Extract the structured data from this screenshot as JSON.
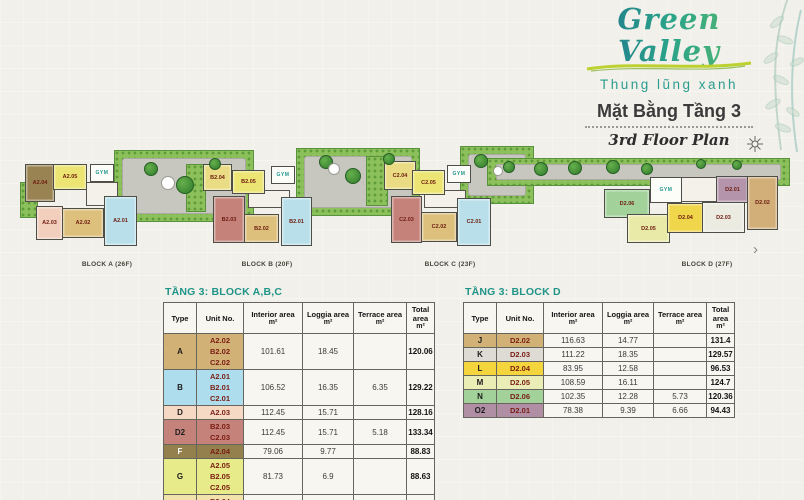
{
  "brand": {
    "name": "Green Valley",
    "tagline": "Thung lũng xanh",
    "plan_title_vi": "Mặt Bằng Tầng 3",
    "plan_title_en": "3rd Floor Plan",
    "teal": "#2a9d8f",
    "accent_green": "#bcd12f"
  },
  "plan": {
    "gym_label": "GYM",
    "next_arrow": "›",
    "blocks": [
      {
        "name": "BLOCK A (26F)",
        "label_x": 107,
        "gym": {
          "x": 90,
          "y": 164,
          "w": 22,
          "h": 16
        },
        "cores": [
          {
            "x": 86,
            "y": 182,
            "w": 30,
            "h": 22
          }
        ],
        "units": [
          {
            "id": "A2.04",
            "x": 25,
            "y": 164,
            "w": 28,
            "h": 36,
            "c": "#998352"
          },
          {
            "id": "A2.05",
            "x": 53,
            "y": 164,
            "w": 32,
            "h": 24,
            "c": "#ece573"
          },
          {
            "id": "A2.03",
            "x": 36,
            "y": 206,
            "w": 25,
            "h": 32,
            "c": "#f2cfbc"
          },
          {
            "id": "A2.02",
            "x": 62,
            "y": 208,
            "w": 40,
            "h": 28,
            "c": "#ddc07c"
          },
          {
            "id": "A2.01",
            "x": 104,
            "y": 196,
            "w": 31,
            "h": 48,
            "c": "#b9e0ea"
          }
        ]
      },
      {
        "name": "BLOCK B (20F)",
        "label_x": 267,
        "gym": {
          "x": 271,
          "y": 166,
          "w": 22,
          "h": 16
        },
        "cores": [
          {
            "x": 248,
            "y": 190,
            "w": 40,
            "h": 16
          }
        ],
        "units": [
          {
            "id": "B2.04",
            "x": 203,
            "y": 164,
            "w": 27,
            "h": 25,
            "c": "#eadc84"
          },
          {
            "id": "B2.05",
            "x": 232,
            "y": 170,
            "w": 31,
            "h": 22,
            "c": "#ece573"
          },
          {
            "id": "B2.03",
            "x": 213,
            "y": 196,
            "w": 30,
            "h": 45,
            "c": "#c5827a"
          },
          {
            "id": "B2.02",
            "x": 244,
            "y": 214,
            "w": 33,
            "h": 27,
            "c": "#ddc07c"
          },
          {
            "id": "B2.01",
            "x": 281,
            "y": 197,
            "w": 29,
            "h": 47,
            "c": "#b9e0ea"
          }
        ]
      },
      {
        "name": "BLOCK C (23F)",
        "label_x": 450,
        "gym": {
          "x": 447,
          "y": 165,
          "w": 22,
          "h": 16
        },
        "cores": [
          {
            "x": 424,
            "y": 190,
            "w": 40,
            "h": 16
          }
        ],
        "units": [
          {
            "id": "C2.04",
            "x": 384,
            "y": 161,
            "w": 30,
            "h": 27,
            "c": "#eadc84"
          },
          {
            "id": "C2.05",
            "x": 412,
            "y": 170,
            "w": 31,
            "h": 23,
            "c": "#ece573"
          },
          {
            "id": "C2.03",
            "x": 391,
            "y": 196,
            "w": 29,
            "h": 45,
            "c": "#c5827a"
          },
          {
            "id": "C2.02",
            "x": 421,
            "y": 212,
            "w": 34,
            "h": 28,
            "c": "#ddc07c"
          },
          {
            "id": "C2.01",
            "x": 457,
            "y": 198,
            "w": 32,
            "h": 46,
            "c": "#b9e0ea"
          }
        ]
      },
      {
        "name": "BLOCK D (27F)",
        "label_x": 707,
        "gym": {
          "x": 650,
          "y": 177,
          "w": 30,
          "h": 24
        },
        "cores": [
          {
            "x": 681,
            "y": 177,
            "w": 34,
            "h": 23
          }
        ],
        "units": [
          {
            "id": "D2.06",
            "x": 604,
            "y": 189,
            "w": 44,
            "h": 27,
            "c": "#a2d29a"
          },
          {
            "id": "D2.05",
            "x": 627,
            "y": 214,
            "w": 41,
            "h": 27,
            "c": "#e9e9a8"
          },
          {
            "id": "D2.04",
            "x": 667,
            "y": 203,
            "w": 35,
            "h": 28,
            "c": "#f0d64a"
          },
          {
            "id": "D2.03",
            "x": 702,
            "y": 202,
            "w": 41,
            "h": 29,
            "c": "#ecebe2"
          },
          {
            "id": "D2.01",
            "x": 716,
            "y": 176,
            "w": 31,
            "h": 25,
            "c": "#b394ab"
          },
          {
            "id": "D2.02",
            "x": 747,
            "y": 176,
            "w": 29,
            "h": 52,
            "c": "#d2ae79"
          }
        ]
      }
    ],
    "gardens": [
      {
        "x": 114,
        "y": 150,
        "w": 138,
        "h": 70,
        "deck": "full"
      },
      {
        "x": 296,
        "y": 148,
        "w": 122,
        "h": 66,
        "deck": "full"
      },
      {
        "x": 460,
        "y": 146,
        "w": 72,
        "h": 56,
        "deck": "full"
      },
      {
        "x": 487,
        "y": 158,
        "w": 301,
        "h": 26,
        "deck": "strip"
      },
      {
        "x": 20,
        "y": 182,
        "w": 16,
        "h": 34
      },
      {
        "x": 186,
        "y": 164,
        "w": 18,
        "h": 46
      },
      {
        "x": 366,
        "y": 156,
        "w": 20,
        "h": 48
      }
    ],
    "trees": [
      {
        "x": 150,
        "y": 168,
        "r": 6
      },
      {
        "x": 184,
        "y": 184,
        "r": 8
      },
      {
        "x": 214,
        "y": 163,
        "r": 5
      },
      {
        "x": 325,
        "y": 161,
        "r": 6
      },
      {
        "x": 352,
        "y": 175,
        "r": 7
      },
      {
        "x": 388,
        "y": 158,
        "r": 5
      },
      {
        "x": 480,
        "y": 160,
        "r": 6
      },
      {
        "x": 508,
        "y": 166,
        "r": 5
      },
      {
        "x": 540,
        "y": 168,
        "r": 6
      },
      {
        "x": 574,
        "y": 167,
        "r": 6
      },
      {
        "x": 612,
        "y": 166,
        "r": 6
      },
      {
        "x": 646,
        "y": 168,
        "r": 5
      },
      {
        "x": 700,
        "y": 163,
        "r": 4
      },
      {
        "x": 736,
        "y": 164,
        "r": 4
      }
    ],
    "pools": [
      {
        "x": 167,
        "y": 182,
        "r": 6
      },
      {
        "x": 333,
        "y": 168,
        "r": 5
      },
      {
        "x": 497,
        "y": 170,
        "r": 4
      }
    ]
  },
  "tables": [
    {
      "title": "TẦNG 3: BLOCK A,B,C",
      "headers": [
        {
          "label": "Type",
          "unit": ""
        },
        {
          "label": "Unit No.",
          "unit": ""
        },
        {
          "label": "Interior area",
          "unit": "m²"
        },
        {
          "label": "Loggia area",
          "unit": "m²"
        },
        {
          "label": "Terrace area",
          "unit": "m²"
        },
        {
          "label": "Total area",
          "unit": "m²"
        }
      ],
      "rows": [
        {
          "type": "A",
          "color": "#d2b177",
          "text_color": "#1c1c1c",
          "units": [
            "A2.02",
            "B2.02",
            "C2.02"
          ],
          "interior": "101.61",
          "loggia": "18.45",
          "terrace": "",
          "total": "120.06"
        },
        {
          "type": "B",
          "color": "#aedeed",
          "text_color": "#1c1c1c",
          "units": [
            "A2.01",
            "B2.01",
            "C2.01"
          ],
          "interior": "106.52",
          "loggia": "16.35",
          "terrace": "6.35",
          "total": "129.22"
        },
        {
          "type": "D",
          "color": "#f6d9c5",
          "text_color": "#1c1c1c",
          "units": [
            "A2.03"
          ],
          "interior": "112.45",
          "loggia": "15.71",
          "terrace": "",
          "total": "128.16"
        },
        {
          "type": "D2",
          "color": "#c5827a",
          "text_color": "#1c1c1c",
          "units": [
            "B2.03",
            "C2.03"
          ],
          "interior": "112.45",
          "loggia": "15.71",
          "terrace": "5.18",
          "total": "133.34"
        },
        {
          "type": "F",
          "color": "#93804d",
          "text_color": "#ffffff",
          "units": [
            "A2.04"
          ],
          "interior": "79.06",
          "loggia": "9.77",
          "terrace": "",
          "total": "88.83"
        },
        {
          "type": "G",
          "color": "#e8eb8a",
          "text_color": "#1c1c1c",
          "units": [
            "A2.05",
            "B2.05",
            "C2.05"
          ],
          "interior": "81.73",
          "loggia": "6.9",
          "terrace": "",
          "total": "88.63"
        },
        {
          "type": "H",
          "color": "#f1e2ab",
          "text_color": "#1c1c1c",
          "units": [
            "B2.04",
            "C2.04"
          ],
          "interior": "73",
          "loggia": "",
          "terrace": "15.12",
          "total": "88.12"
        }
      ]
    },
    {
      "title": "TẦNG 3: BLOCK D",
      "headers": [
        {
          "label": "Type",
          "unit": ""
        },
        {
          "label": "Unit No.",
          "unit": ""
        },
        {
          "label": "Interior area",
          "unit": "m²"
        },
        {
          "label": "Loggia area",
          "unit": "m²"
        },
        {
          "label": "Terrace area",
          "unit": "m²"
        },
        {
          "label": "Total area",
          "unit": "m²"
        }
      ],
      "rows": [
        {
          "type": "J",
          "color": "#d2b177",
          "text_color": "#1c1c1c",
          "units": [
            "D2.02"
          ],
          "interior": "116.63",
          "loggia": "14.77",
          "terrace": "",
          "total": "131.4"
        },
        {
          "type": "K",
          "color": "#dddbd3",
          "text_color": "#1c1c1c",
          "units": [
            "D2.03"
          ],
          "interior": "111.22",
          "loggia": "18.35",
          "terrace": "",
          "total": "129.57"
        },
        {
          "type": "L",
          "color": "#f4d53d",
          "text_color": "#1c1c1c",
          "units": [
            "D2.04"
          ],
          "interior": "83.95",
          "loggia": "12.58",
          "terrace": "",
          "total": "96.53"
        },
        {
          "type": "M",
          "color": "#ebedb6",
          "text_color": "#1c1c1c",
          "units": [
            "D2.05"
          ],
          "interior": "108.59",
          "loggia": "16.11",
          "terrace": "",
          "total": "124.7"
        },
        {
          "type": "N",
          "color": "#a2d29a",
          "text_color": "#1c1c1c",
          "units": [
            "D2.06"
          ],
          "interior": "102.35",
          "loggia": "12.28",
          "terrace": "5.73",
          "total": "120.36"
        },
        {
          "type": "O2",
          "color": "#b08fa5",
          "text_color": "#1c1c1c",
          "units": [
            "D2.01"
          ],
          "interior": "78.38",
          "loggia": "9.39",
          "terrace": "6.66",
          "total": "94.43"
        }
      ]
    }
  ]
}
